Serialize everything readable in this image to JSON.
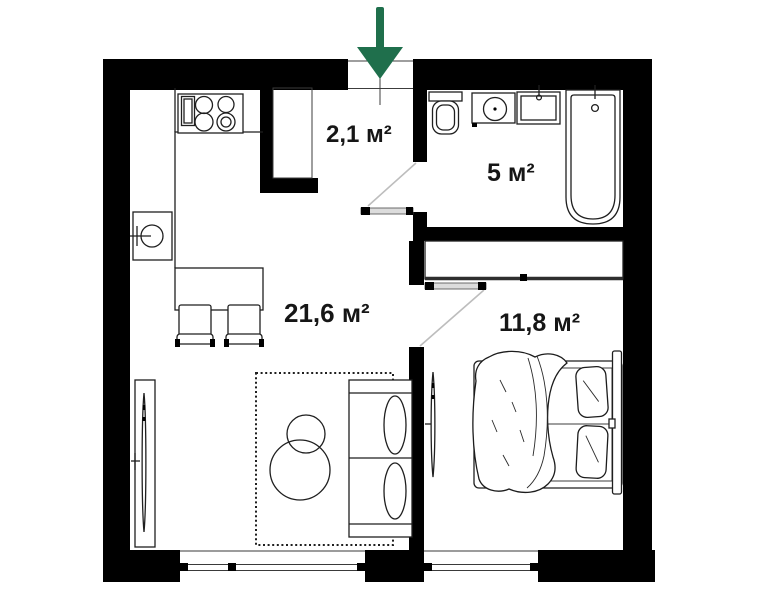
{
  "plan": {
    "type": "apartment-floor-plan",
    "rooms": {
      "hallway": {
        "name": "hallway",
        "area_label": "2,1 м²"
      },
      "bathroom": {
        "name": "bathroom",
        "area_label": "5 м²"
      },
      "living": {
        "name": "living-room-kitchen",
        "area_label": "21,6 м²"
      },
      "bedroom": {
        "name": "bedroom",
        "area_label": "11,8 м²"
      }
    },
    "colors": {
      "wall": "#000000",
      "linework": "#1f1f1f",
      "door_leaf": "#dcdcdc",
      "entrance_arrow": "#1f6f4c"
    },
    "entrance": {
      "marker": "green-arrow-down"
    },
    "fixtures": {
      "hallway": [
        "entry-closet"
      ],
      "bathroom": [
        "toilet",
        "washing-machine",
        "sink",
        "bathtub"
      ],
      "kitchen": [
        "counter",
        "stove",
        "kitchen-sink",
        "dining-table",
        "chair",
        "chair"
      ],
      "living": [
        "tv-stand",
        "tv",
        "rug",
        "coffee-table",
        "coffee-table",
        "sofa"
      ],
      "bedroom": [
        "wardrobe",
        "wall-tv",
        "double-bed",
        "pillow",
        "pillow",
        "duvet"
      ]
    }
  }
}
